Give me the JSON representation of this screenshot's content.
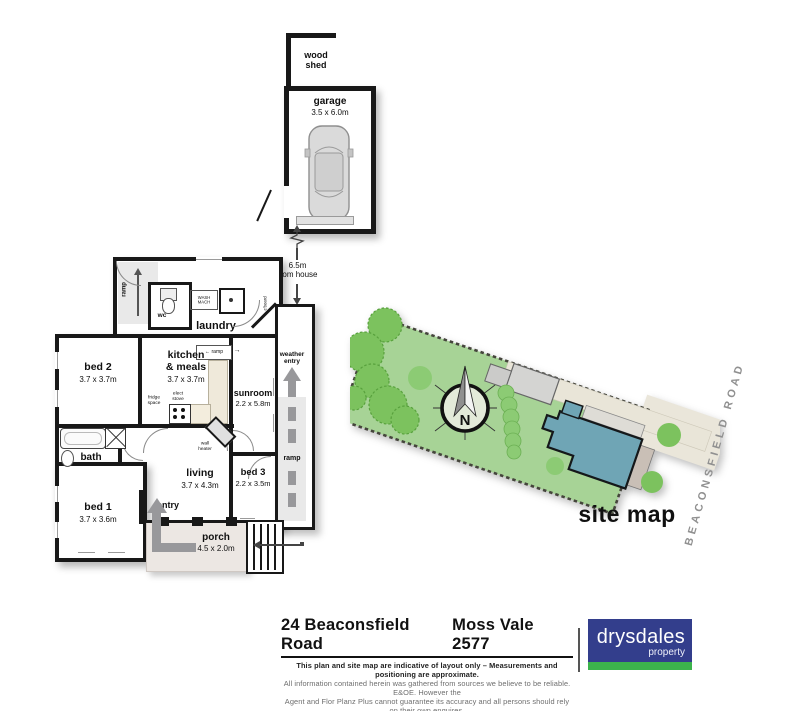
{
  "floorplan": {
    "woodshed": {
      "line1": "wood",
      "line2": "shed"
    },
    "garage": {
      "label": "garage",
      "dim": "3.5 x 6.0m"
    },
    "distance": {
      "line1": "6.5m",
      "line2": "from house"
    },
    "laundry": {
      "label": "laundry"
    },
    "wc": {
      "label": "wc"
    },
    "washmach": {
      "line1": "WASH",
      "line2": "MACH"
    },
    "cboard": {
      "label": "c'board"
    },
    "bed2": {
      "label": "bed 2",
      "dim": "3.7 x 3.7m"
    },
    "kitchen": {
      "line1": "kitchen",
      "line2": "& meals",
      "dim": "3.7 x 3.7m"
    },
    "fridge": {
      "line1": "fridge",
      "line2": "space"
    },
    "stove": {
      "line1": "elect",
      "line2": "stove"
    },
    "sunroom": {
      "label": "sunroom",
      "dim": "2.2 x 5.8m"
    },
    "weather": {
      "line1": "weather",
      "line2": "entry"
    },
    "wallheater": {
      "line1": "wall",
      "line2": "heater"
    },
    "bath": {
      "label": "bath"
    },
    "living": {
      "label": "living",
      "dim": "3.7 x 4.3m"
    },
    "bed3": {
      "label": "bed 3",
      "dim": "2.2 x 3.5m"
    },
    "bed1": {
      "label": "bed 1",
      "dim": "3.7 x 3.6m"
    },
    "entry": {
      "label": "entry"
    },
    "porch": {
      "label": "porch",
      "dim": "4.5 x 2.0m"
    },
    "ramp_top": {
      "label": "ramp"
    },
    "ramp_kitchen": {
      "label": "ramp"
    },
    "ramp_side": {
      "label": "ramp"
    },
    "icons": {
      "arrow_left": "←",
      "arrow_right": "→"
    }
  },
  "sitemap": {
    "label": "site map",
    "road": "BEACONSFIELD ROAD",
    "compass": "N"
  },
  "footer": {
    "address_left": "24 Beaconsfield Road",
    "address_right": "Moss Vale 2577",
    "disclaimer_line1": "This plan and site map are indicative of layout only  –  Measurements and positioning are approximate.",
    "disclaimer_line2": "All information contained herein was gathered from sources we believe to be reliable. E&OE. However the",
    "disclaimer_line3": "Agent and Flor Planz Plus cannot guarantee its accuracy and all persons should rely on their own enquires.",
    "drawn_by": "Drawn by",
    "email_part1": "florplanz",
    "email_part2": "plus@gmail.com",
    "phone": "0427 496 264",
    "date": "• 11052017",
    "copyright": "copyrite©",
    "logo_name": "drysdales",
    "logo_sub": "property",
    "colors": {
      "navy": "#333e8c",
      "green": "#3cb34c"
    }
  }
}
